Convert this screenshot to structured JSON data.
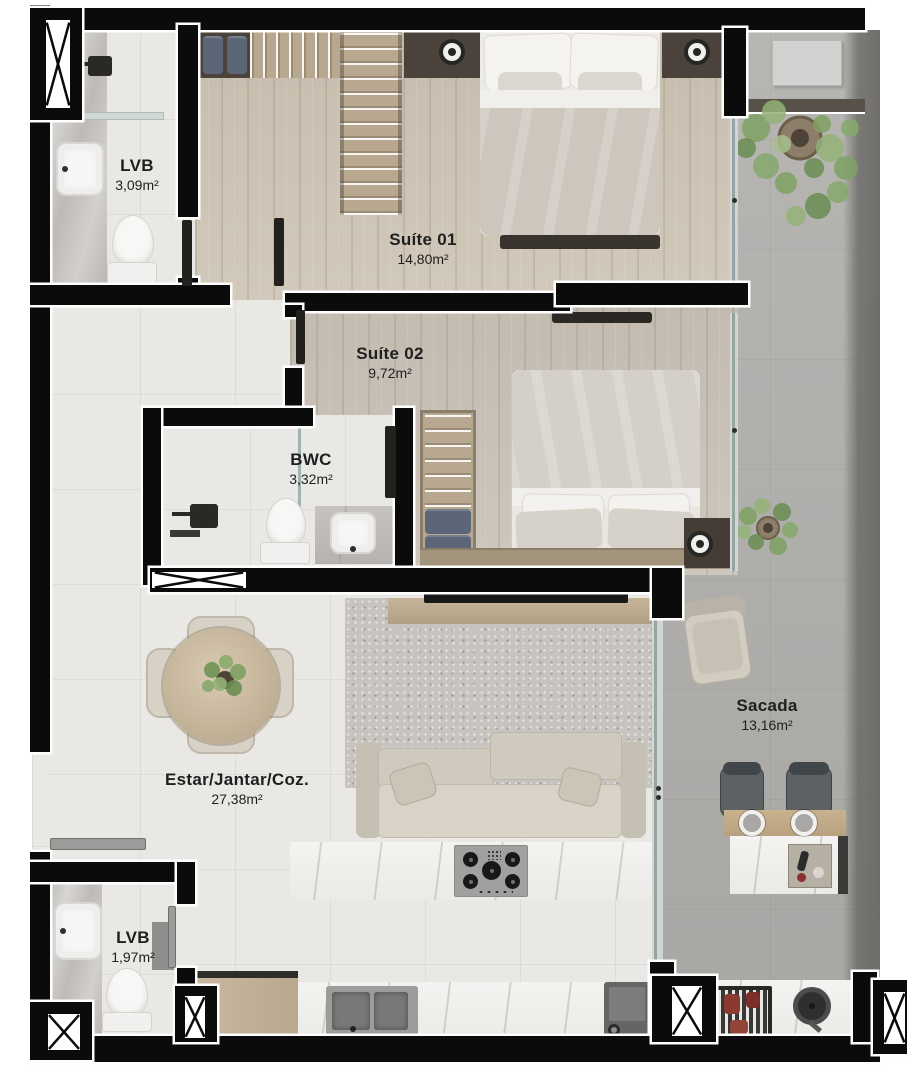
{
  "document": {
    "type": "apartment-floor-plan"
  },
  "rooms": {
    "lvb_top": {
      "name": "LVB",
      "area": "3,09m²"
    },
    "suite01": {
      "name": "Suíte 01",
      "area": "14,80m²"
    },
    "suite02": {
      "name": "Suíte 02",
      "area": "9,72m²"
    },
    "bwc": {
      "name": "BWC",
      "area": "3,32m²"
    },
    "estar": {
      "name": "Estar/Jantar/Coz.",
      "area": "27,38m²"
    },
    "sacada": {
      "name": "Sacada",
      "area": "13,16m²"
    },
    "lvb_bottom": {
      "name": "LVB",
      "area": "1,97m²"
    }
  },
  "colors": {
    "wall": "#0b0b0b",
    "wall_outline": "#fefefe",
    "wood_floor": "#cfc6b7",
    "tile_floor": "#e9e8e5",
    "concrete_floor": "#b3b1ae",
    "dark_wood": "#4a423b",
    "plant_green": "#7fa163",
    "label_text": "#1f1f1f",
    "page_background": "#ffffff"
  }
}
